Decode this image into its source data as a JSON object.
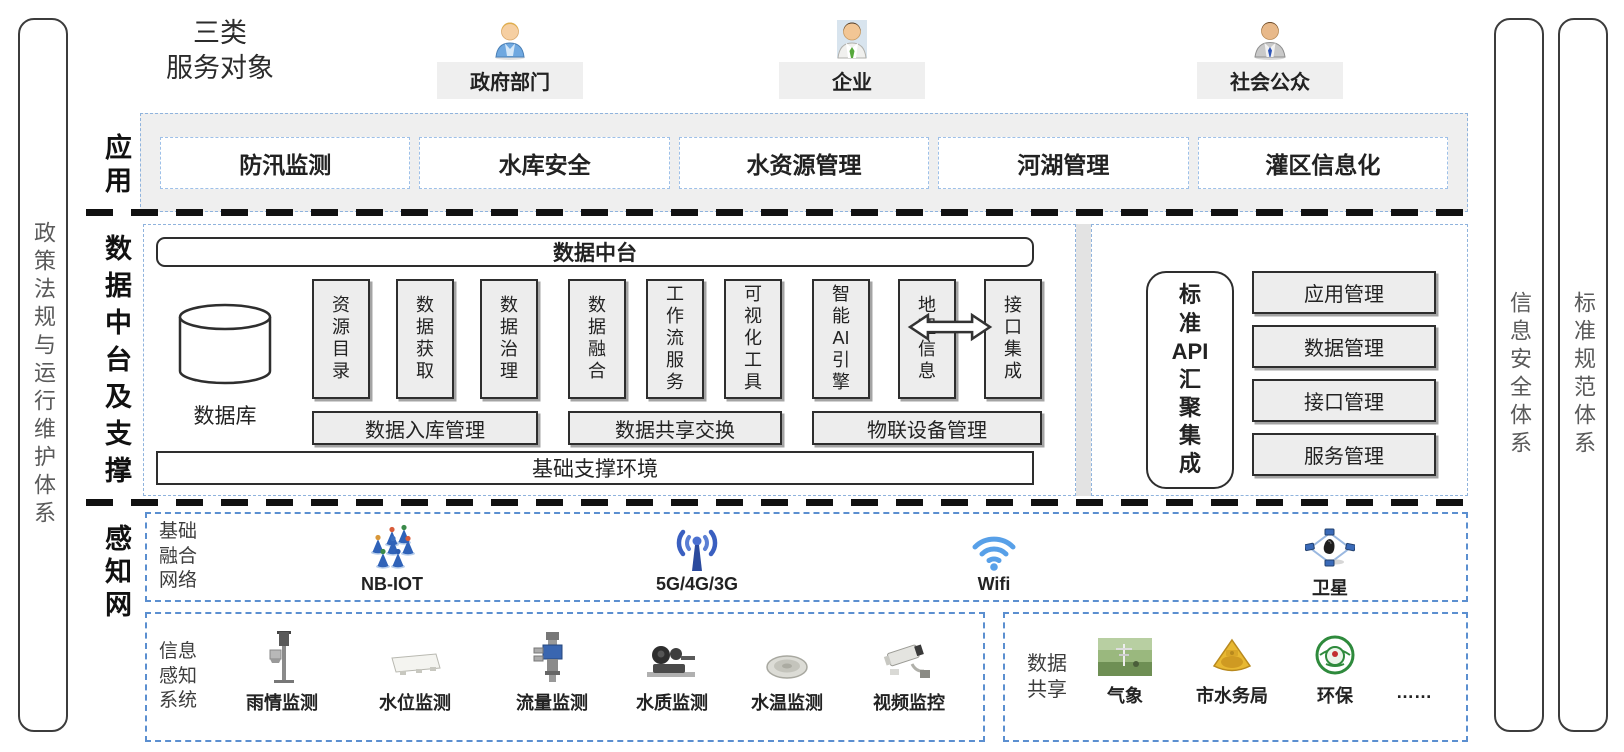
{
  "pillars": {
    "left": "政策法规与运行维护体系",
    "right1": "信息安全体系",
    "right2": "标准规范体系"
  },
  "header": {
    "title_lines": [
      "三类",
      "服务对象"
    ],
    "audiences": [
      {
        "label": "政府部门",
        "icon": "gov-person"
      },
      {
        "label": "企业",
        "icon": "enterprise-person"
      },
      {
        "label": "社会公众",
        "icon": "public-person"
      }
    ]
  },
  "app_row": {
    "side_label": "应用",
    "items": [
      "防汛监测",
      "水库安全",
      "水资源管理",
      "河湖管理",
      "灌区信息化"
    ]
  },
  "platform": {
    "side_label": "数据中台及支撑",
    "header": "数据中台",
    "database_label": "数据库",
    "groups": [
      {
        "columns": [
          [
            "资",
            "源",
            "目",
            "录"
          ],
          [
            "数",
            "据",
            "获",
            "取"
          ],
          [
            "数",
            "据",
            "治",
            "理"
          ]
        ],
        "bar": "数据入库管理"
      },
      {
        "columns": [
          [
            "数",
            "据",
            "融",
            "合"
          ],
          [
            "工",
            "作",
            "流",
            "服",
            "务"
          ],
          [
            "可",
            "视",
            "化",
            "工",
            "具"
          ]
        ],
        "bar": "数据共享交换"
      },
      {
        "columns": [
          [
            "智",
            "能",
            "AI",
            "引",
            "擎"
          ],
          [
            "地",
            "理",
            "信",
            "息"
          ],
          [
            "接",
            "口",
            "集",
            "成"
          ]
        ],
        "bar": "物联设备管理"
      }
    ],
    "footer": "基础支撑环境"
  },
  "api_panel": {
    "box_lines": [
      "标",
      "准",
      "API",
      "汇",
      "聚",
      "集",
      "成"
    ],
    "mgmt_items": [
      "应用管理",
      "数据管理",
      "接口管理",
      "服务管理"
    ]
  },
  "sensing": {
    "side_label": "感知网",
    "network": {
      "label_lines": [
        "基础",
        "融合",
        "网络"
      ],
      "items": [
        {
          "icon": "nbiot-cluster",
          "label": "NB-IOT"
        },
        {
          "icon": "cell-antenna",
          "label": "5G/4G/3G"
        },
        {
          "icon": "wifi",
          "label": "Wifi"
        },
        {
          "icon": "satellite",
          "label": "卫星"
        }
      ]
    },
    "devices": {
      "label_lines": [
        "信息",
        "感知",
        "系统"
      ],
      "items": [
        {
          "icon": "rain-gauge",
          "label": "雨情监测"
        },
        {
          "icon": "water-level",
          "label": "水位监测"
        },
        {
          "icon": "flow-meter",
          "label": "流量监测"
        },
        {
          "icon": "water-quality",
          "label": "水质监测"
        },
        {
          "icon": "water-temp",
          "label": "水温监测"
        },
        {
          "icon": "cctv-camera",
          "label": "视频监控"
        }
      ]
    },
    "sharing": {
      "label_lines": [
        "数据",
        "共享"
      ],
      "items": [
        {
          "icon": "weather-photo",
          "label": "气象"
        },
        {
          "icon": "gold-emblem",
          "label": "市水务局"
        },
        {
          "icon": "green-emblem",
          "label": "环保"
        },
        {
          "icon": "none",
          "label": "……"
        }
      ]
    }
  },
  "colors": {
    "dashed_blue_border": "#8fb3dd",
    "sensing_border": "#5b8fd0",
    "panel_fill": "#efefef",
    "box_fill": "#ededed",
    "dark_border": "#2e2e2e",
    "divider_black": "#111111",
    "wifi_blue": "#58a0e8",
    "antenna_blue": "#3a5fc0"
  }
}
